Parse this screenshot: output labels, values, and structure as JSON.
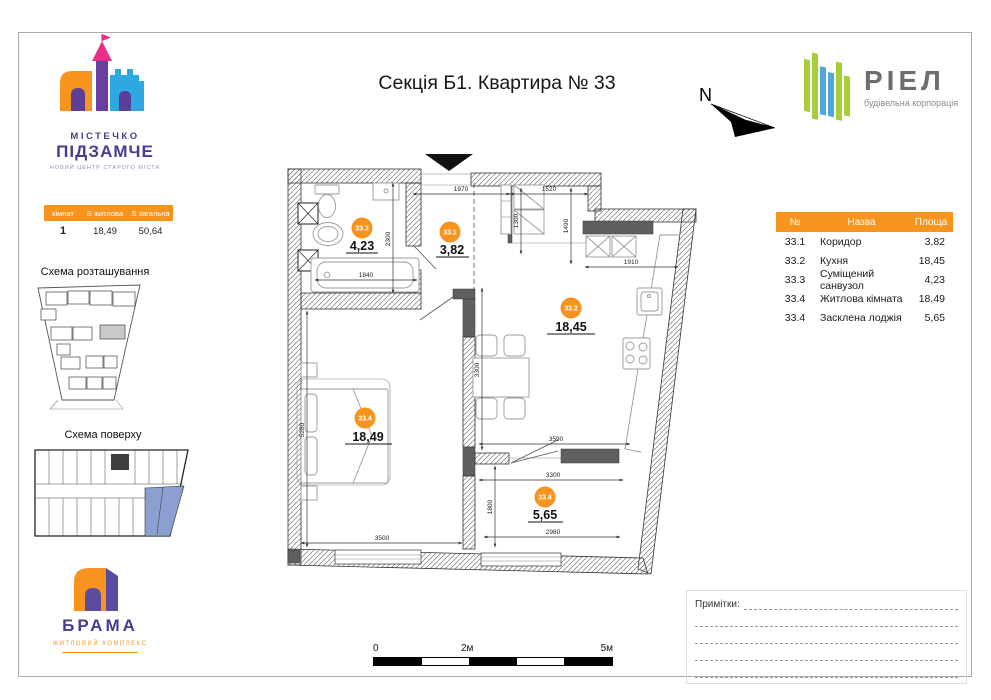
{
  "page": {
    "title": "Секція Б1. Квартира № 33"
  },
  "branding": {
    "estate_name_line1": "МІСТЕЧКО",
    "estate_name_line2": "ПІДЗАМЧЕ",
    "estate_tagline": "НОВИЙ ЦЕНТР СТАРОГО МІСТА",
    "developer_name": "РІЕЛ",
    "developer_tagline": "будівельна корпорація",
    "complex_name": "БРАМА",
    "complex_tagline": "ЖИТЛОВИЙ КОМПЛЕКС",
    "north_label": "N"
  },
  "summary_table": {
    "headers": [
      "кімнат",
      "S житлова",
      "S загальна"
    ],
    "row": {
      "rooms": "1",
      "living_area": "18,49",
      "total_area": "50,64"
    }
  },
  "schemes": {
    "location_title": "Схема розташування",
    "floor_title": "Схема поверху"
  },
  "rooms_table": {
    "headers": [
      "№",
      "Назва",
      "Площа"
    ],
    "rows": [
      {
        "num": "33.1",
        "name": "Коридор",
        "area": "3,82"
      },
      {
        "num": "33.2",
        "name": "Кухня",
        "area": "18,45"
      },
      {
        "num": "33.3",
        "name": "Суміщений санвузол",
        "area": "4,23"
      },
      {
        "num": "33.4",
        "name": "Житлова кімната",
        "area": "18,49"
      },
      {
        "num": "33.4",
        "name": "Засклена лоджія",
        "area": "5,65"
      }
    ]
  },
  "plan": {
    "rooms": [
      {
        "num": "33.3",
        "area": "4,23"
      },
      {
        "num": "33.1",
        "area": "3,82"
      },
      {
        "num": "33.2",
        "area": "18,45"
      },
      {
        "num": "33.4",
        "area": "18,49"
      },
      {
        "num": "33.4",
        "area": "5,65"
      }
    ],
    "dims": [
      "1970",
      "1520",
      "1300",
      "1490",
      "1910",
      "2300",
      "1840",
      "5280",
      "3300",
      "3590",
      "3300",
      "1800",
      "3500",
      "2980"
    ]
  },
  "notes": {
    "label": "Примітки:"
  },
  "scalebar": {
    "labels": [
      "0",
      "2м",
      "5м"
    ]
  },
  "colors": {
    "accent_orange": "#F7941E",
    "brand_purple": "#4B3B8F",
    "castle_pink": "#E8308A",
    "castle_blue": "#2FA8E1",
    "riel_green": "#A6CE39",
    "riel_blue": "#4FA8D8",
    "riel_gray": "#6D6E71",
    "highlight_blue": "#8C9FD0"
  }
}
